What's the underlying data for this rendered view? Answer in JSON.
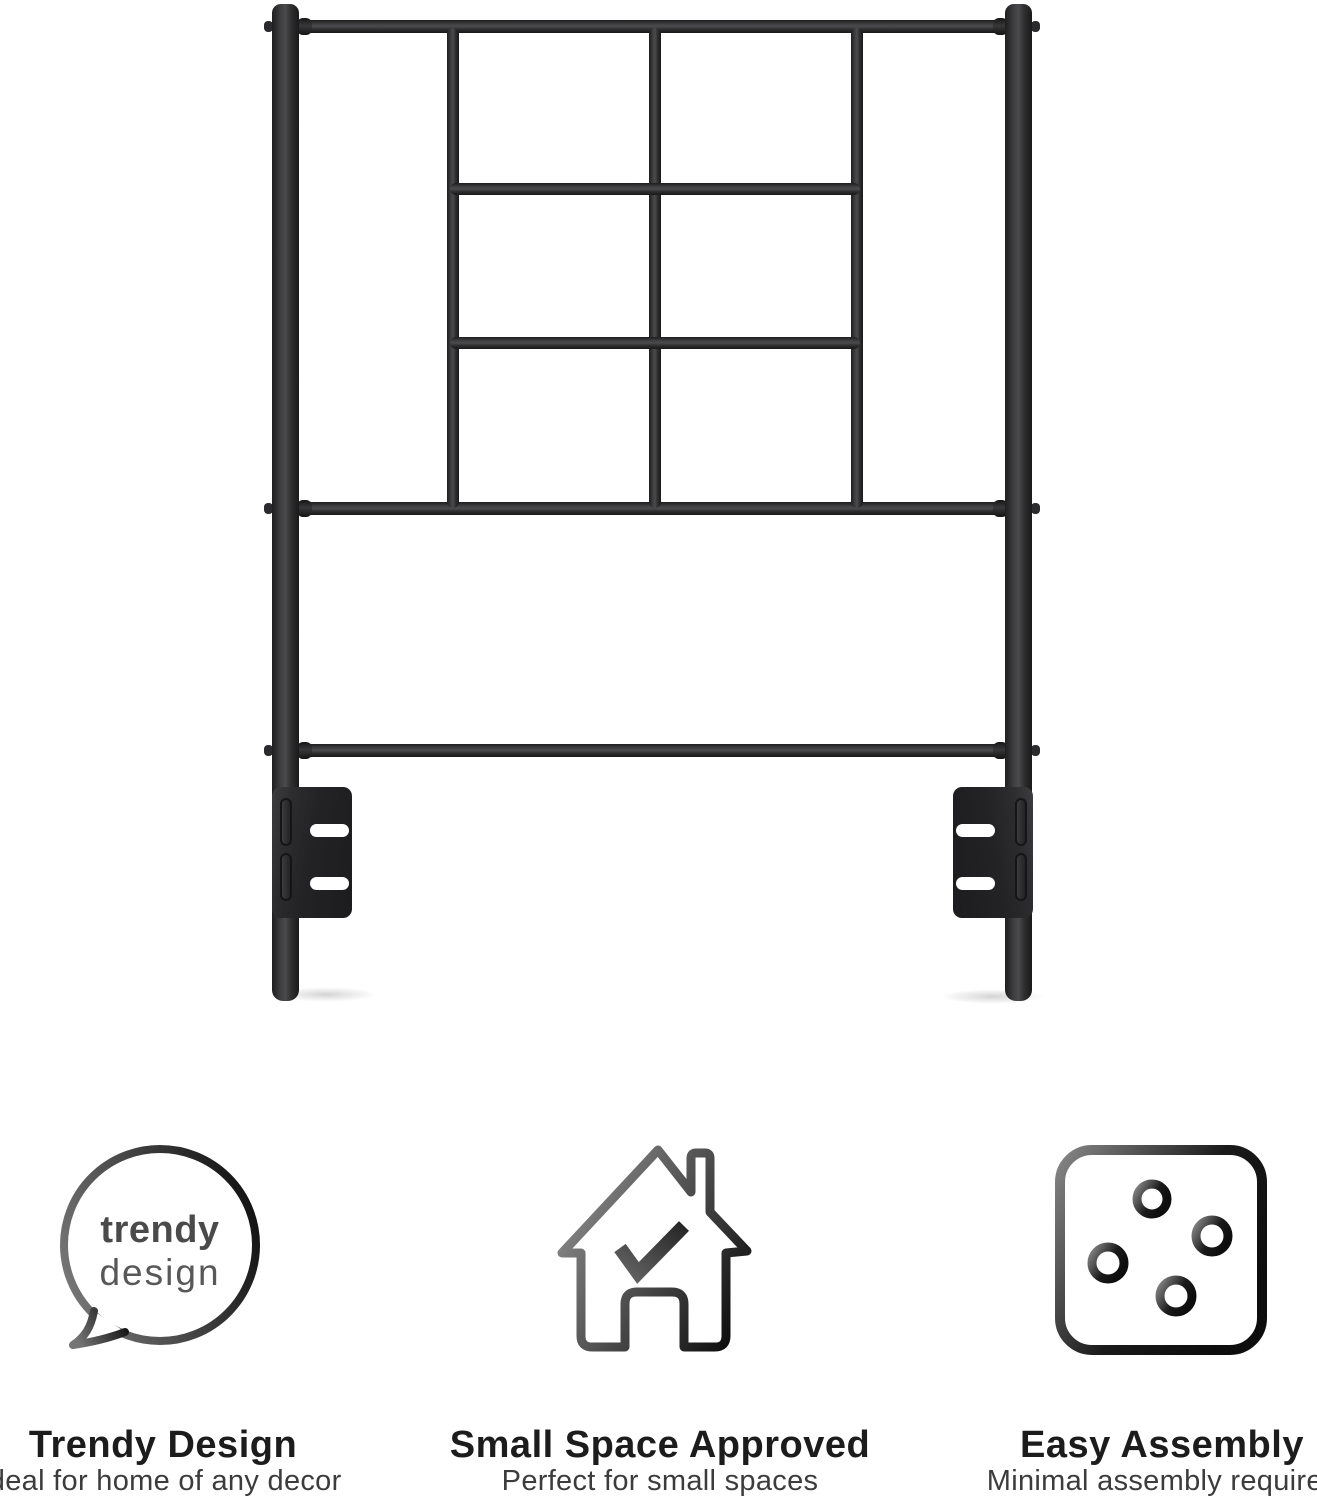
{
  "bubble": {
    "line1": "trendy",
    "line2": "design"
  },
  "features": [
    {
      "icon": "speech-bubble-icon",
      "title": "Trendy Design",
      "subtitle": "Ideal for home of any decor"
    },
    {
      "icon": "house-check-icon",
      "title": "Small Space Approved",
      "subtitle": "Perfect for small spaces"
    },
    {
      "icon": "puzzle-icon",
      "title": "Easy Assembly",
      "subtitle": "Minimal assembly required"
    }
  ],
  "colors": {
    "background": "#ffffff",
    "metal_dark": "#1e1e1f",
    "metal_highlight": "#4b4b4e",
    "bracket": "#232325",
    "heading_text": "#1c1c1c",
    "subtitle_text": "#3c3c3c",
    "icon_gradient_light": "#868686",
    "icon_gradient_dark": "#121212"
  }
}
